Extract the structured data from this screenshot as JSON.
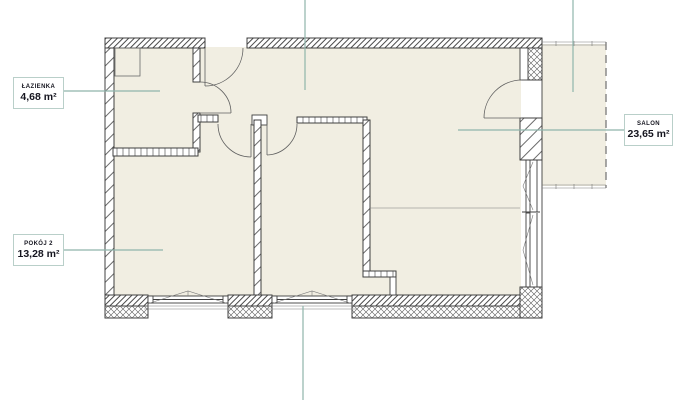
{
  "page": {
    "type": "apartment-floor-plan"
  },
  "colors": {
    "background": "#ffffff",
    "floor": "#f1eee2",
    "wall_line": "#3f3f3f",
    "leader_line": "#8fb5ab",
    "label_border": "#b9cfc9",
    "label_text": "#15151f",
    "balcony_dash": "#7a7a7a"
  },
  "labels": {
    "lazienka": {
      "name": "ŁAZIENKA",
      "area": "4,68 m²"
    },
    "pokoj2": {
      "name": "POKÓJ 2",
      "area": "13,28 m²"
    },
    "salon": {
      "name": "SALON",
      "area": "23,65 m²"
    }
  }
}
